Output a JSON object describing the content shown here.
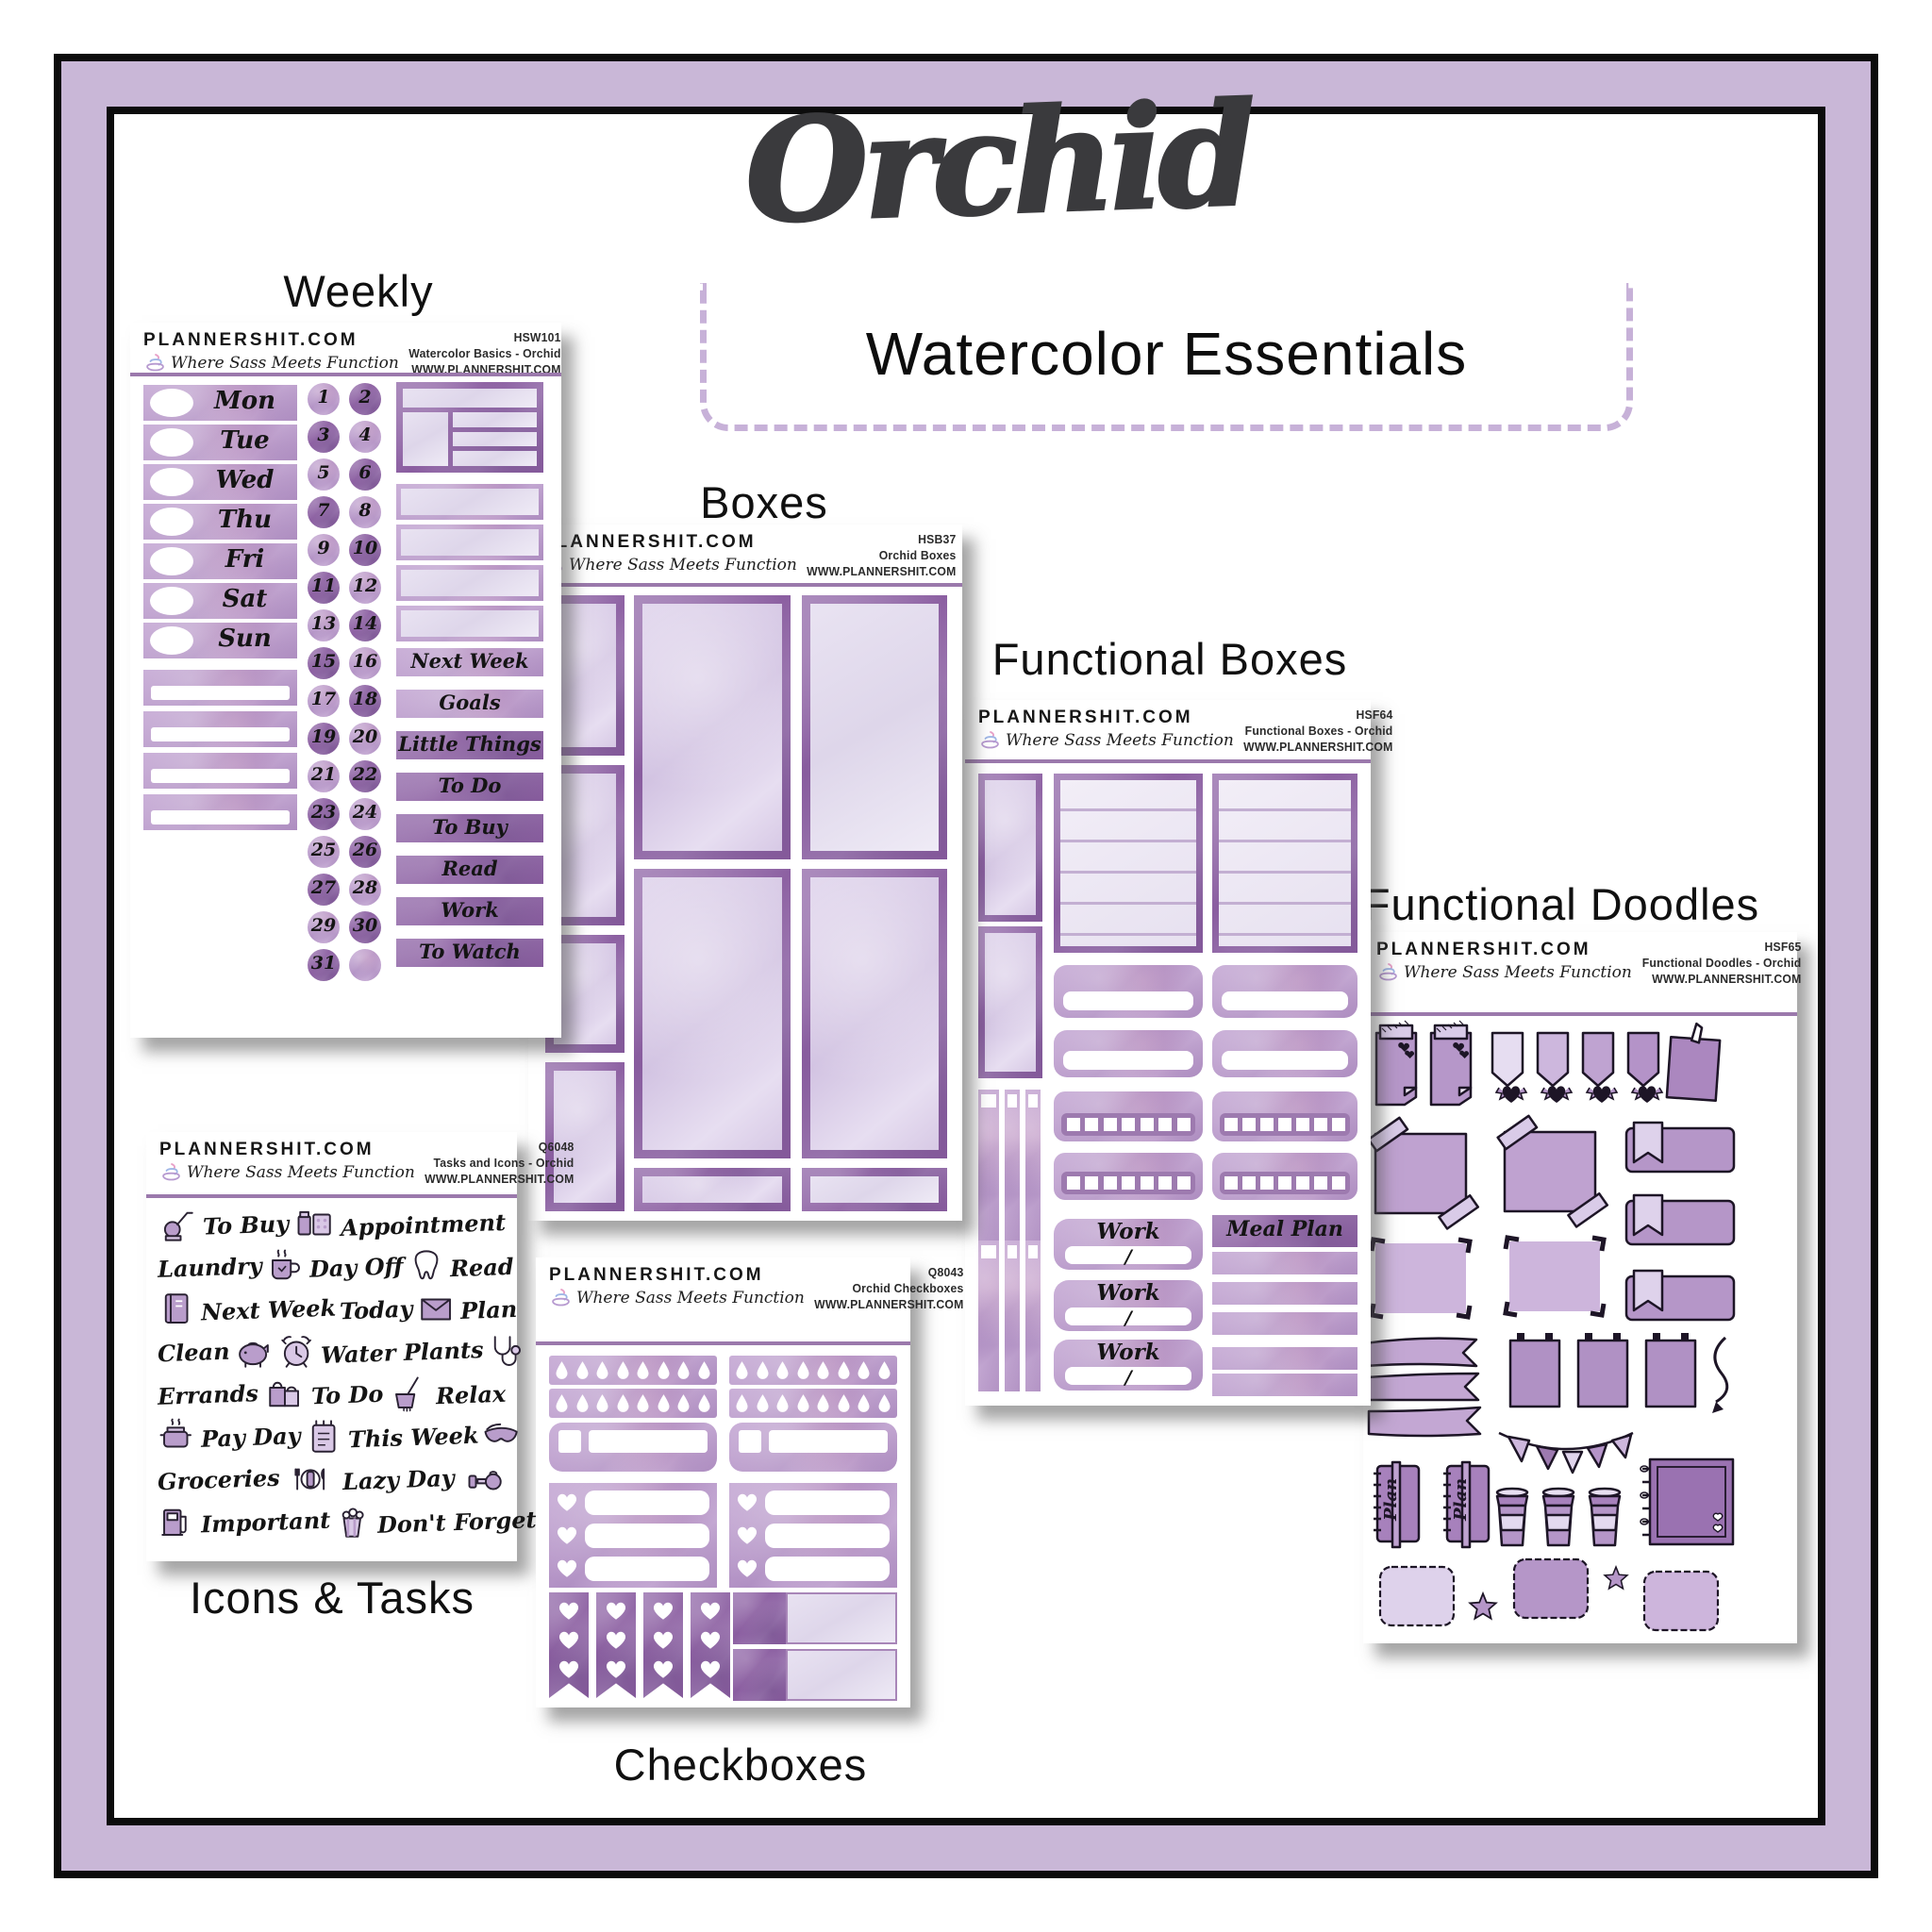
{
  "title": "Orchid",
  "subtitle": "Watercolor Essentials",
  "brand": {
    "name": "PLANNERSHIT.COM",
    "tagline": "Where Sass Meets Function",
    "url": "WWW.PLANNERSHIT.COM",
    "logo_icon": "swirl-icon"
  },
  "colors": {
    "frame_band": "#c9b7d7",
    "frame_line": "#0c0c0c",
    "title_ink": "#3a3a3d",
    "separator": "#9b79ac",
    "dashed_border": "#c7b1d8",
    "sticker_dark": "#8a5da0",
    "sticker_mid": "#b698c7",
    "sticker_light": "#ddd2ea"
  },
  "sheets": {
    "weekly": {
      "caption": "Weekly",
      "code": "HSW101",
      "product": "Watercolor Basics - Orchid",
      "days": [
        "Mon",
        "Tue",
        "Wed",
        "Thu",
        "Fri",
        "Sat",
        "Sun"
      ],
      "dates": [
        1,
        2,
        3,
        4,
        5,
        6,
        7,
        8,
        9,
        10,
        11,
        12,
        13,
        14,
        15,
        16,
        17,
        18,
        19,
        20,
        21,
        22,
        23,
        24,
        25,
        26,
        27,
        28,
        29,
        30,
        31
      ],
      "labels": [
        "Next Week",
        "Goals",
        "Little Things",
        "To Do",
        "To Buy",
        "Read",
        "Work",
        "To Watch"
      ]
    },
    "boxes": {
      "caption": "Boxes",
      "code": "HSB37",
      "product": "Orchid Boxes"
    },
    "functional_boxes": {
      "caption": "Functional Boxes",
      "code": "HSF64",
      "product": "Functional Boxes - Orchid",
      "work_label": "Work",
      "work_slash": "/",
      "meal_plan_label": "Meal Plan"
    },
    "functional_doodles": {
      "caption": "Functional Doodles",
      "code": "HSF65",
      "product": "Functional Doodles - Orchid",
      "plan_label": "Plan"
    },
    "icons_tasks": {
      "caption": "Icons & Tasks",
      "code": "Q6048",
      "product": "Tasks and Icons - Orchid",
      "rows": [
        [
          {
            "icon": "vacuum"
          },
          {
            "text": "To Buy"
          },
          {
            "icon": "pills"
          },
          {
            "text": "Appointment"
          }
        ],
        [
          {
            "text": "Laundry"
          },
          {
            "icon": "mug"
          },
          {
            "text": "Day Off"
          },
          {
            "icon": "tooth"
          },
          {
            "text": "Read"
          }
        ],
        [
          {
            "icon": "book"
          },
          {
            "text": "Next Week"
          },
          {
            "text": "Today"
          },
          {
            "icon": "envelope"
          },
          {
            "text": "Plan"
          }
        ],
        [
          {
            "text": "Clean"
          },
          {
            "icon": "piggy-bank"
          },
          {
            "icon": "alarm-clock"
          },
          {
            "text": "Water Plants"
          },
          {
            "icon": "stethoscope"
          }
        ],
        [
          {
            "text": "Errands"
          },
          {
            "icon": "shopping-bags"
          },
          {
            "text": "To Do"
          },
          {
            "icon": "mop-bucket"
          },
          {
            "text": "Relax"
          }
        ],
        [
          {
            "icon": "cooking-pot"
          },
          {
            "text": "Pay Day"
          },
          {
            "icon": "notepad"
          },
          {
            "text": "This Week"
          },
          {
            "icon": "sleep-mask"
          }
        ],
        [
          {
            "text": "Groceries"
          },
          {
            "icon": "place-setting"
          },
          {
            "text": "Lazy Day"
          },
          {
            "icon": "dumbbells"
          }
        ],
        [
          {
            "icon": "gas-pump"
          },
          {
            "text": "Important"
          },
          {
            "icon": "popcorn"
          },
          {
            "text": "Don't Forget"
          }
        ]
      ]
    },
    "checkboxes": {
      "caption": "Checkboxes",
      "code": "Q8043",
      "product": "Orchid Checkboxes"
    }
  }
}
